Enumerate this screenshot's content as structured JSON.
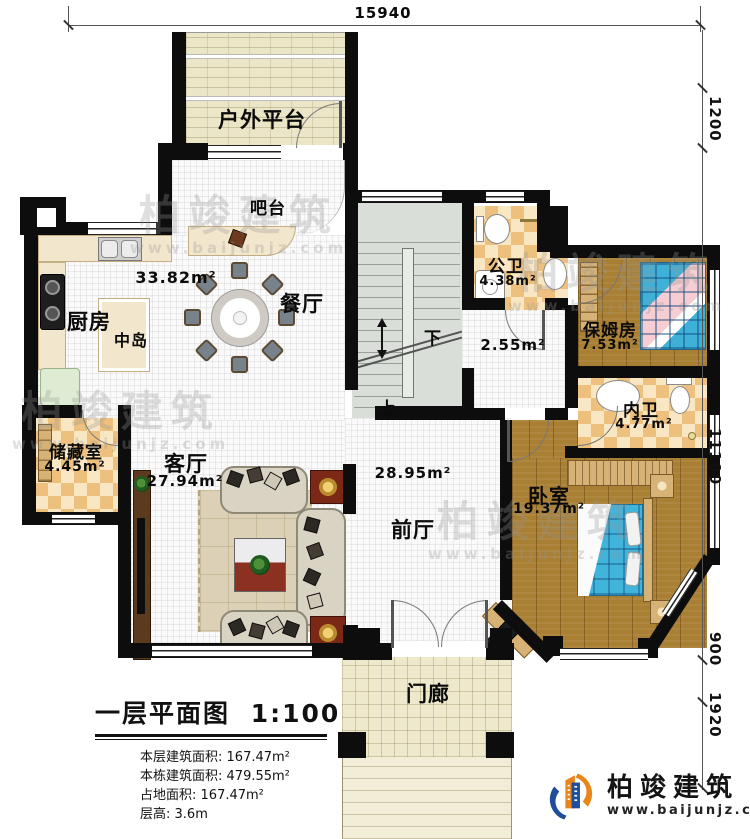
{
  "dimensions": {
    "top": "15940",
    "r1": "1200",
    "r2": "11100",
    "r3": "900",
    "r4": "1920"
  },
  "rooms": {
    "platform": {
      "name": "户外平台"
    },
    "bar": {
      "name": "吧台"
    },
    "kitchen": {
      "name": "厨房"
    },
    "island": {
      "name": "中岛"
    },
    "dining": {
      "name": "餐厅",
      "area": "33.82m²"
    },
    "public_bath": {
      "name": "公卫",
      "area": "4.38m²"
    },
    "corridor": {
      "area": "2.55m²"
    },
    "nanny_room": {
      "name": "保姆房",
      "area": "7.53m²"
    },
    "inner_bath": {
      "name": "内卫",
      "area": "4.77m²"
    },
    "storage": {
      "name": "储藏室",
      "area": "4.45m²"
    },
    "living": {
      "name": "客厅",
      "area": "27.94m²"
    },
    "foyer": {
      "name": "前厅",
      "area": "28.95m²"
    },
    "bedroom": {
      "name": "卧室",
      "area": "19.37m²"
    },
    "porch": {
      "name": "门廊"
    }
  },
  "stairs": {
    "down": "下",
    "up": "上"
  },
  "title_block": {
    "title": "一层平面图",
    "scale": "1:100",
    "stats": [
      {
        "label": "本层建筑面积:",
        "value": "167.47m²"
      },
      {
        "label": "本栋建筑面积:",
        "value": "479.55m²"
      },
      {
        "label": "占地面积:",
        "value": "167.47m²"
      },
      {
        "label": "层高:",
        "value": "3.6m"
      }
    ]
  },
  "brand": {
    "name": "柏竣建筑",
    "url": "www.baijunjz.com"
  },
  "watermark": {
    "name": "柏竣建筑",
    "url": "www.baijunjz.com"
  }
}
